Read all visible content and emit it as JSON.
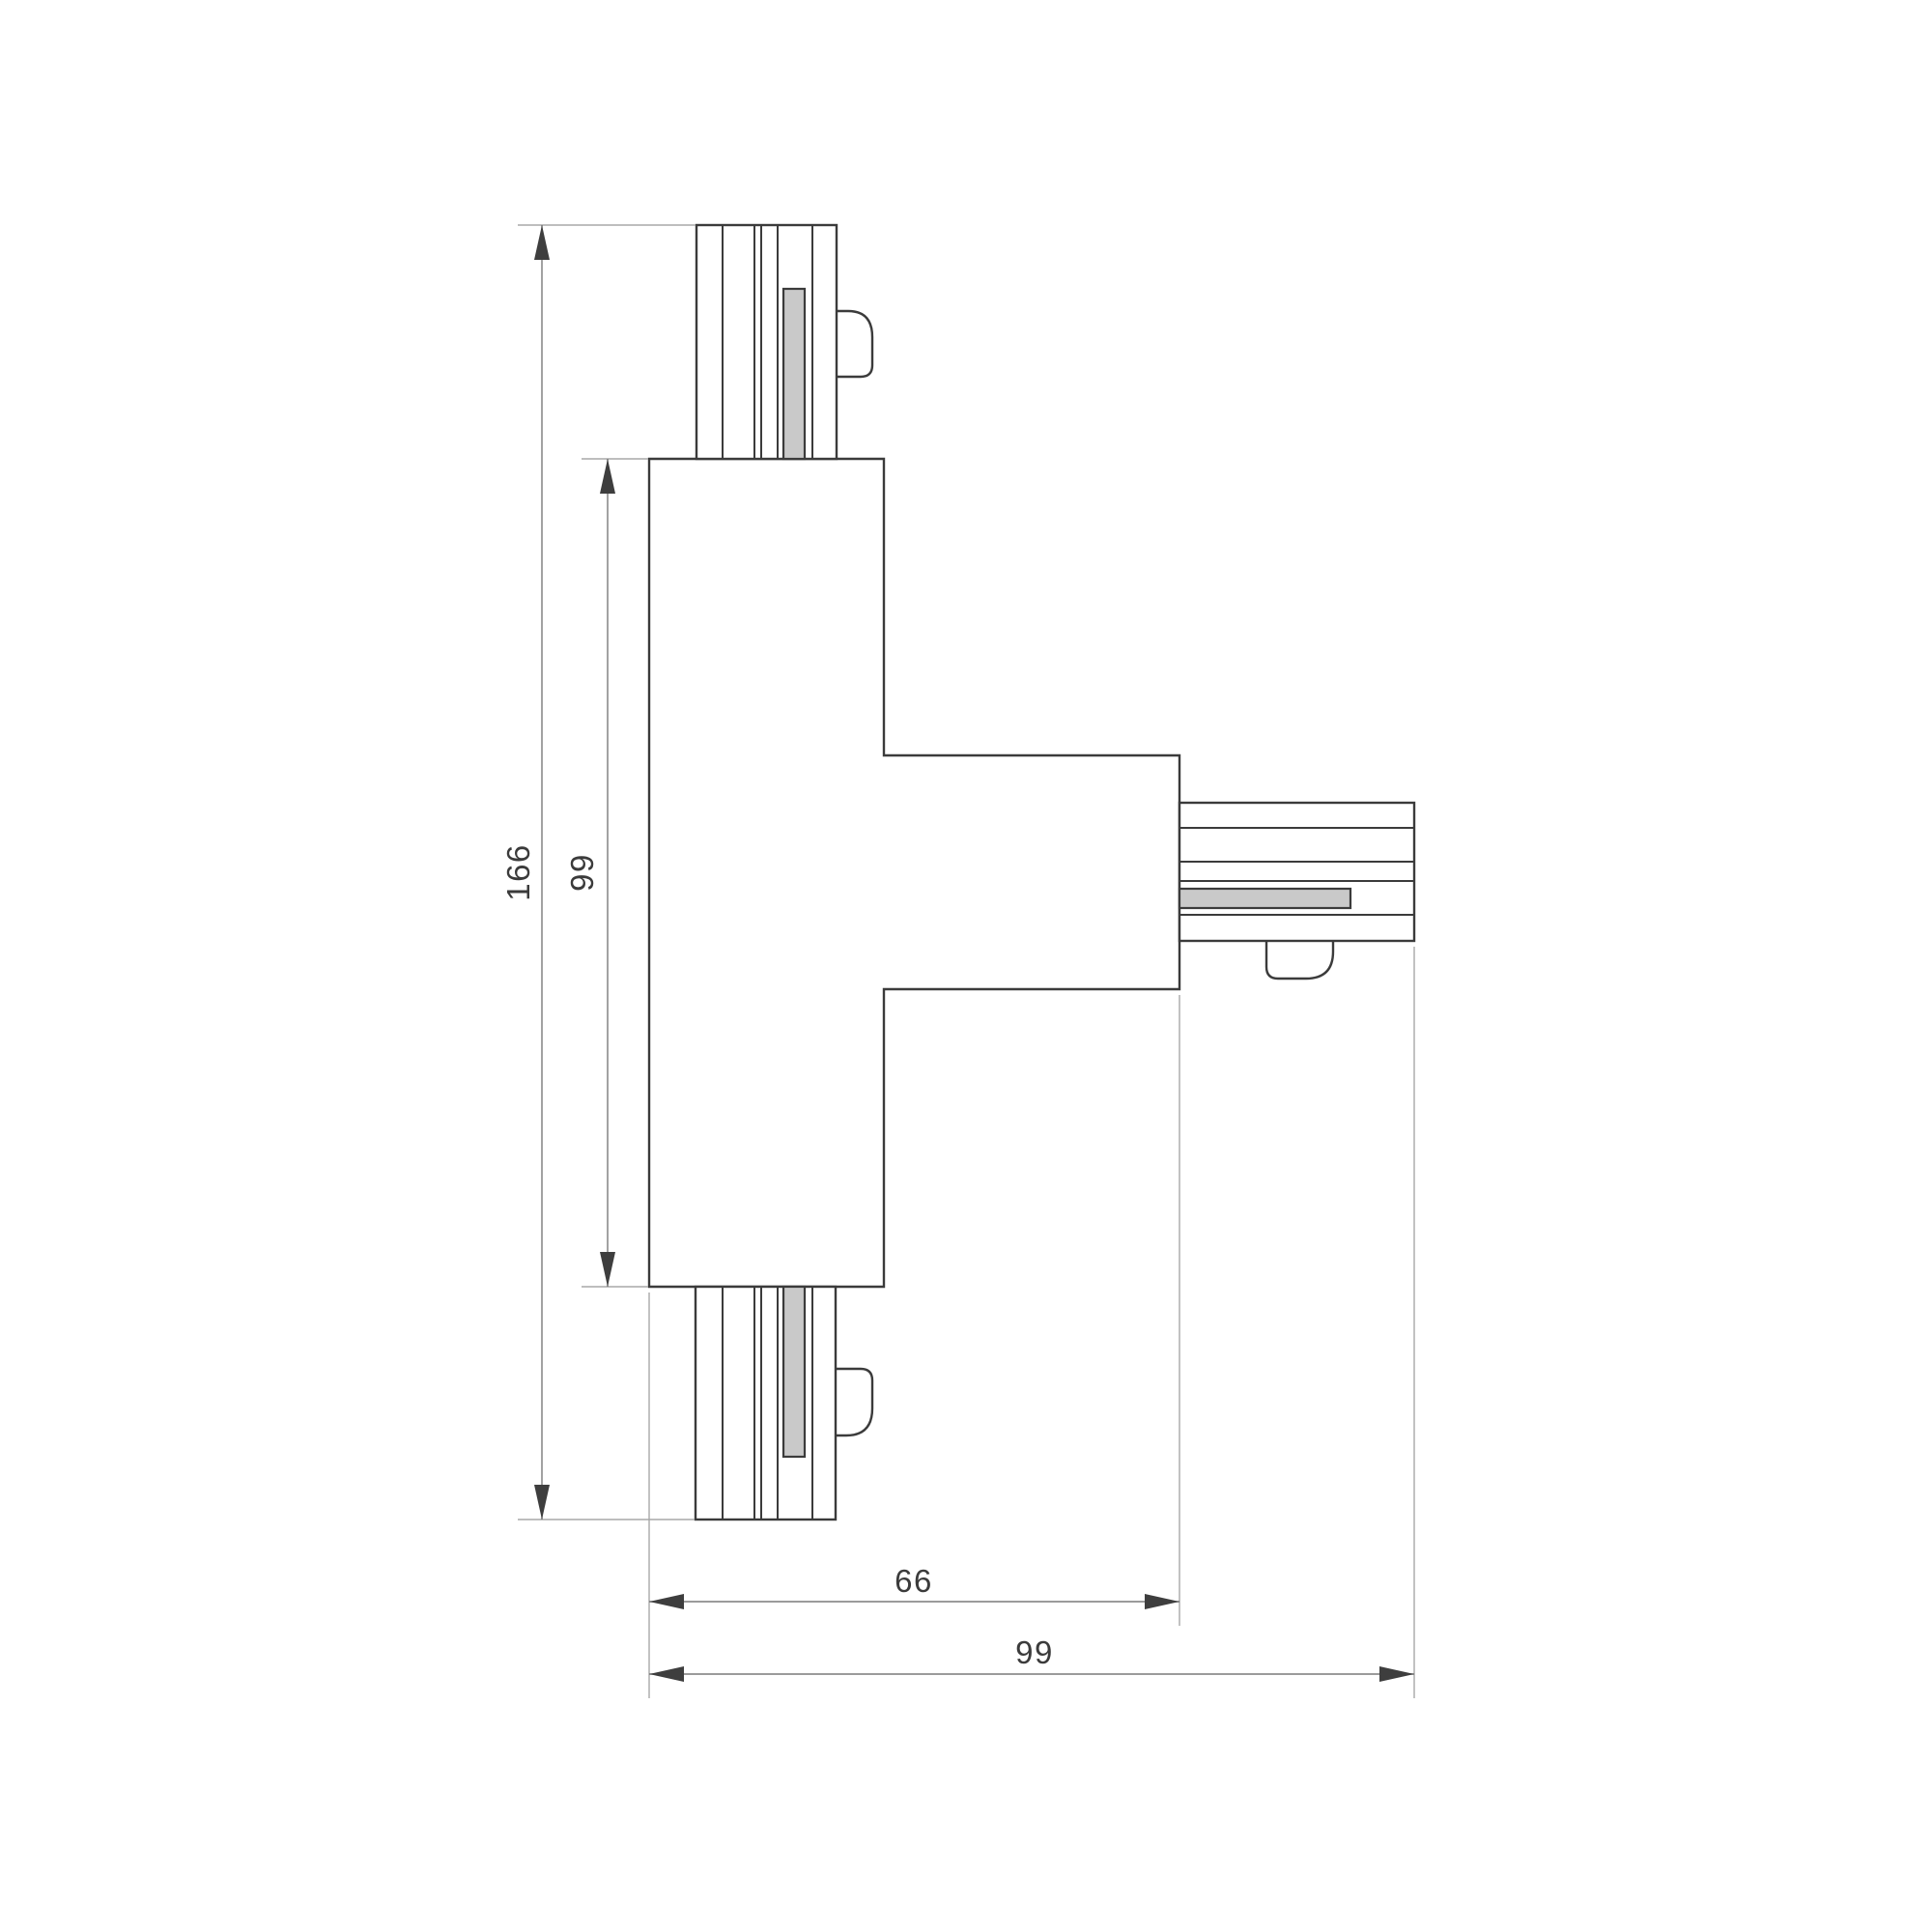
{
  "colors": {
    "background": "#ffffff",
    "outline": "#3b3b3b",
    "shape_fill": "#ffffff",
    "contact_fill": "#c9c9c9",
    "dimension_line": "#7a7a7a",
    "extension_line": "#a8a8a8",
    "arrow": "#3e3e3e",
    "text": "#3b3b3b"
  },
  "dimensions": {
    "overall_height": {
      "value": "166",
      "orientation": "vertical"
    },
    "body_height": {
      "value": "99",
      "orientation": "vertical"
    },
    "width_to_arm_end": {
      "value": "66",
      "orientation": "horizontal"
    },
    "overall_width": {
      "value": "99",
      "orientation": "horizontal"
    }
  }
}
